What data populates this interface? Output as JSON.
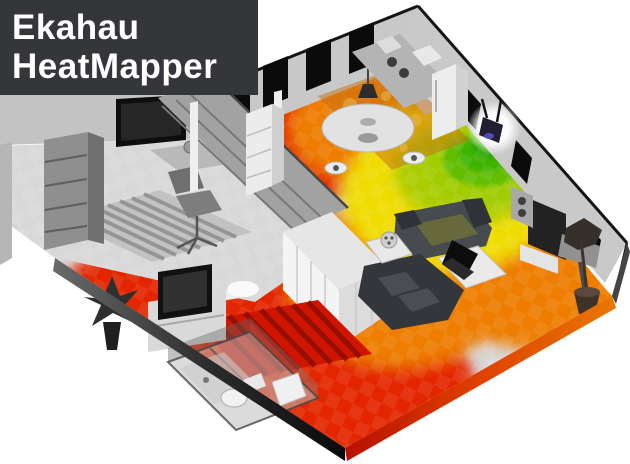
{
  "brand": {
    "line1": "Ekahau",
    "line2": "HeatMapper"
  },
  "scene": {
    "description": "3D isometric apartment floor plan with Wi-Fi signal strength heatmap",
    "access_point": {
      "name": "wifi-access-point",
      "mounted_on": "right wall",
      "glow": true
    },
    "rooms": [
      "office",
      "library-hall",
      "bedroom",
      "bathroom",
      "dining-room",
      "kitchen",
      "living-room",
      "balcony"
    ]
  },
  "colors": {
    "background": "#ffffff",
    "logo_bg": "#35363a",
    "logo_text": "#ffffff",
    "no_coverage": "#d8d8d8",
    "wall": "#c8c8c8",
    "wall_dark": "#9c9c9c",
    "window": "#0b0b0b",
    "outline": "#151515",
    "signal_weak": "#e32600",
    "signal_fair": "#ee7d00",
    "signal_medium": "#f0dc00",
    "signal_good": "#aacc00",
    "signal_strong": "#52bd00",
    "signal_strongest": "#2fa800",
    "ap_accent": "#5a4fc8",
    "slab_shadow": "#0a0a0a"
  }
}
